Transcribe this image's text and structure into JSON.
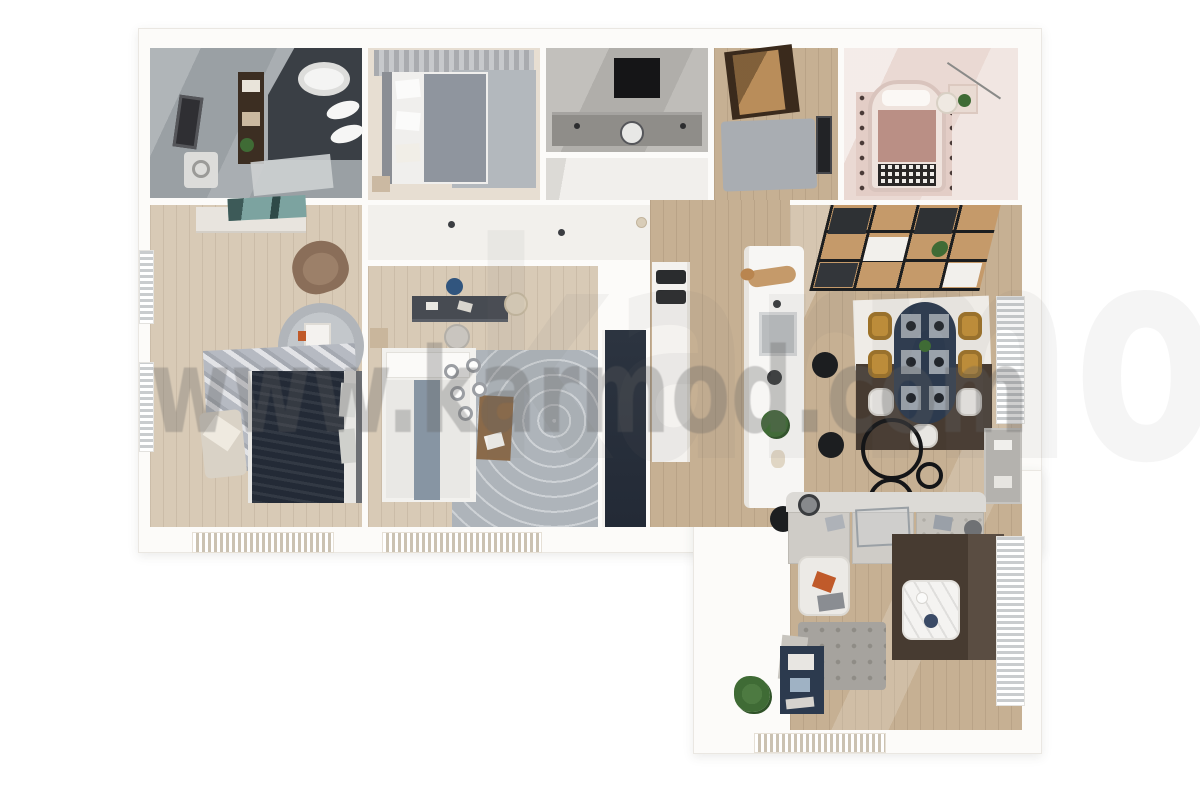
{
  "watermark": {
    "text": "www.karmod.com",
    "text_large": "karmod.com"
  },
  "palette": {
    "wall": "#fcfbf9",
    "wall-edge": "#eae7e2",
    "tile": "#9aa0a4",
    "charcoal": "#3a3f45",
    "wood": "#c6b093",
    "wood-light": "#d8cab6",
    "pale": "#f2f0ec",
    "navy": "#2c3a4e",
    "navy-dark": "#232a36",
    "mustard": "#c28f36",
    "sofa": "#cfccc7",
    "ottoman": "#a6a39e",
    "rug-brown": "#473b31",
    "rug-gray": "#aeb4ba",
    "blush": "#ead9d3",
    "rose": "#ba8f85",
    "door-wood": "#b98d5a",
    "shelf-wood": "#c59a6a",
    "black": "#1c1e20",
    "marble": "#f4f3f1",
    "green": "#3f6b35",
    "orange": "#c05a2a",
    "watermark-color": "#5f5f5f"
  }
}
